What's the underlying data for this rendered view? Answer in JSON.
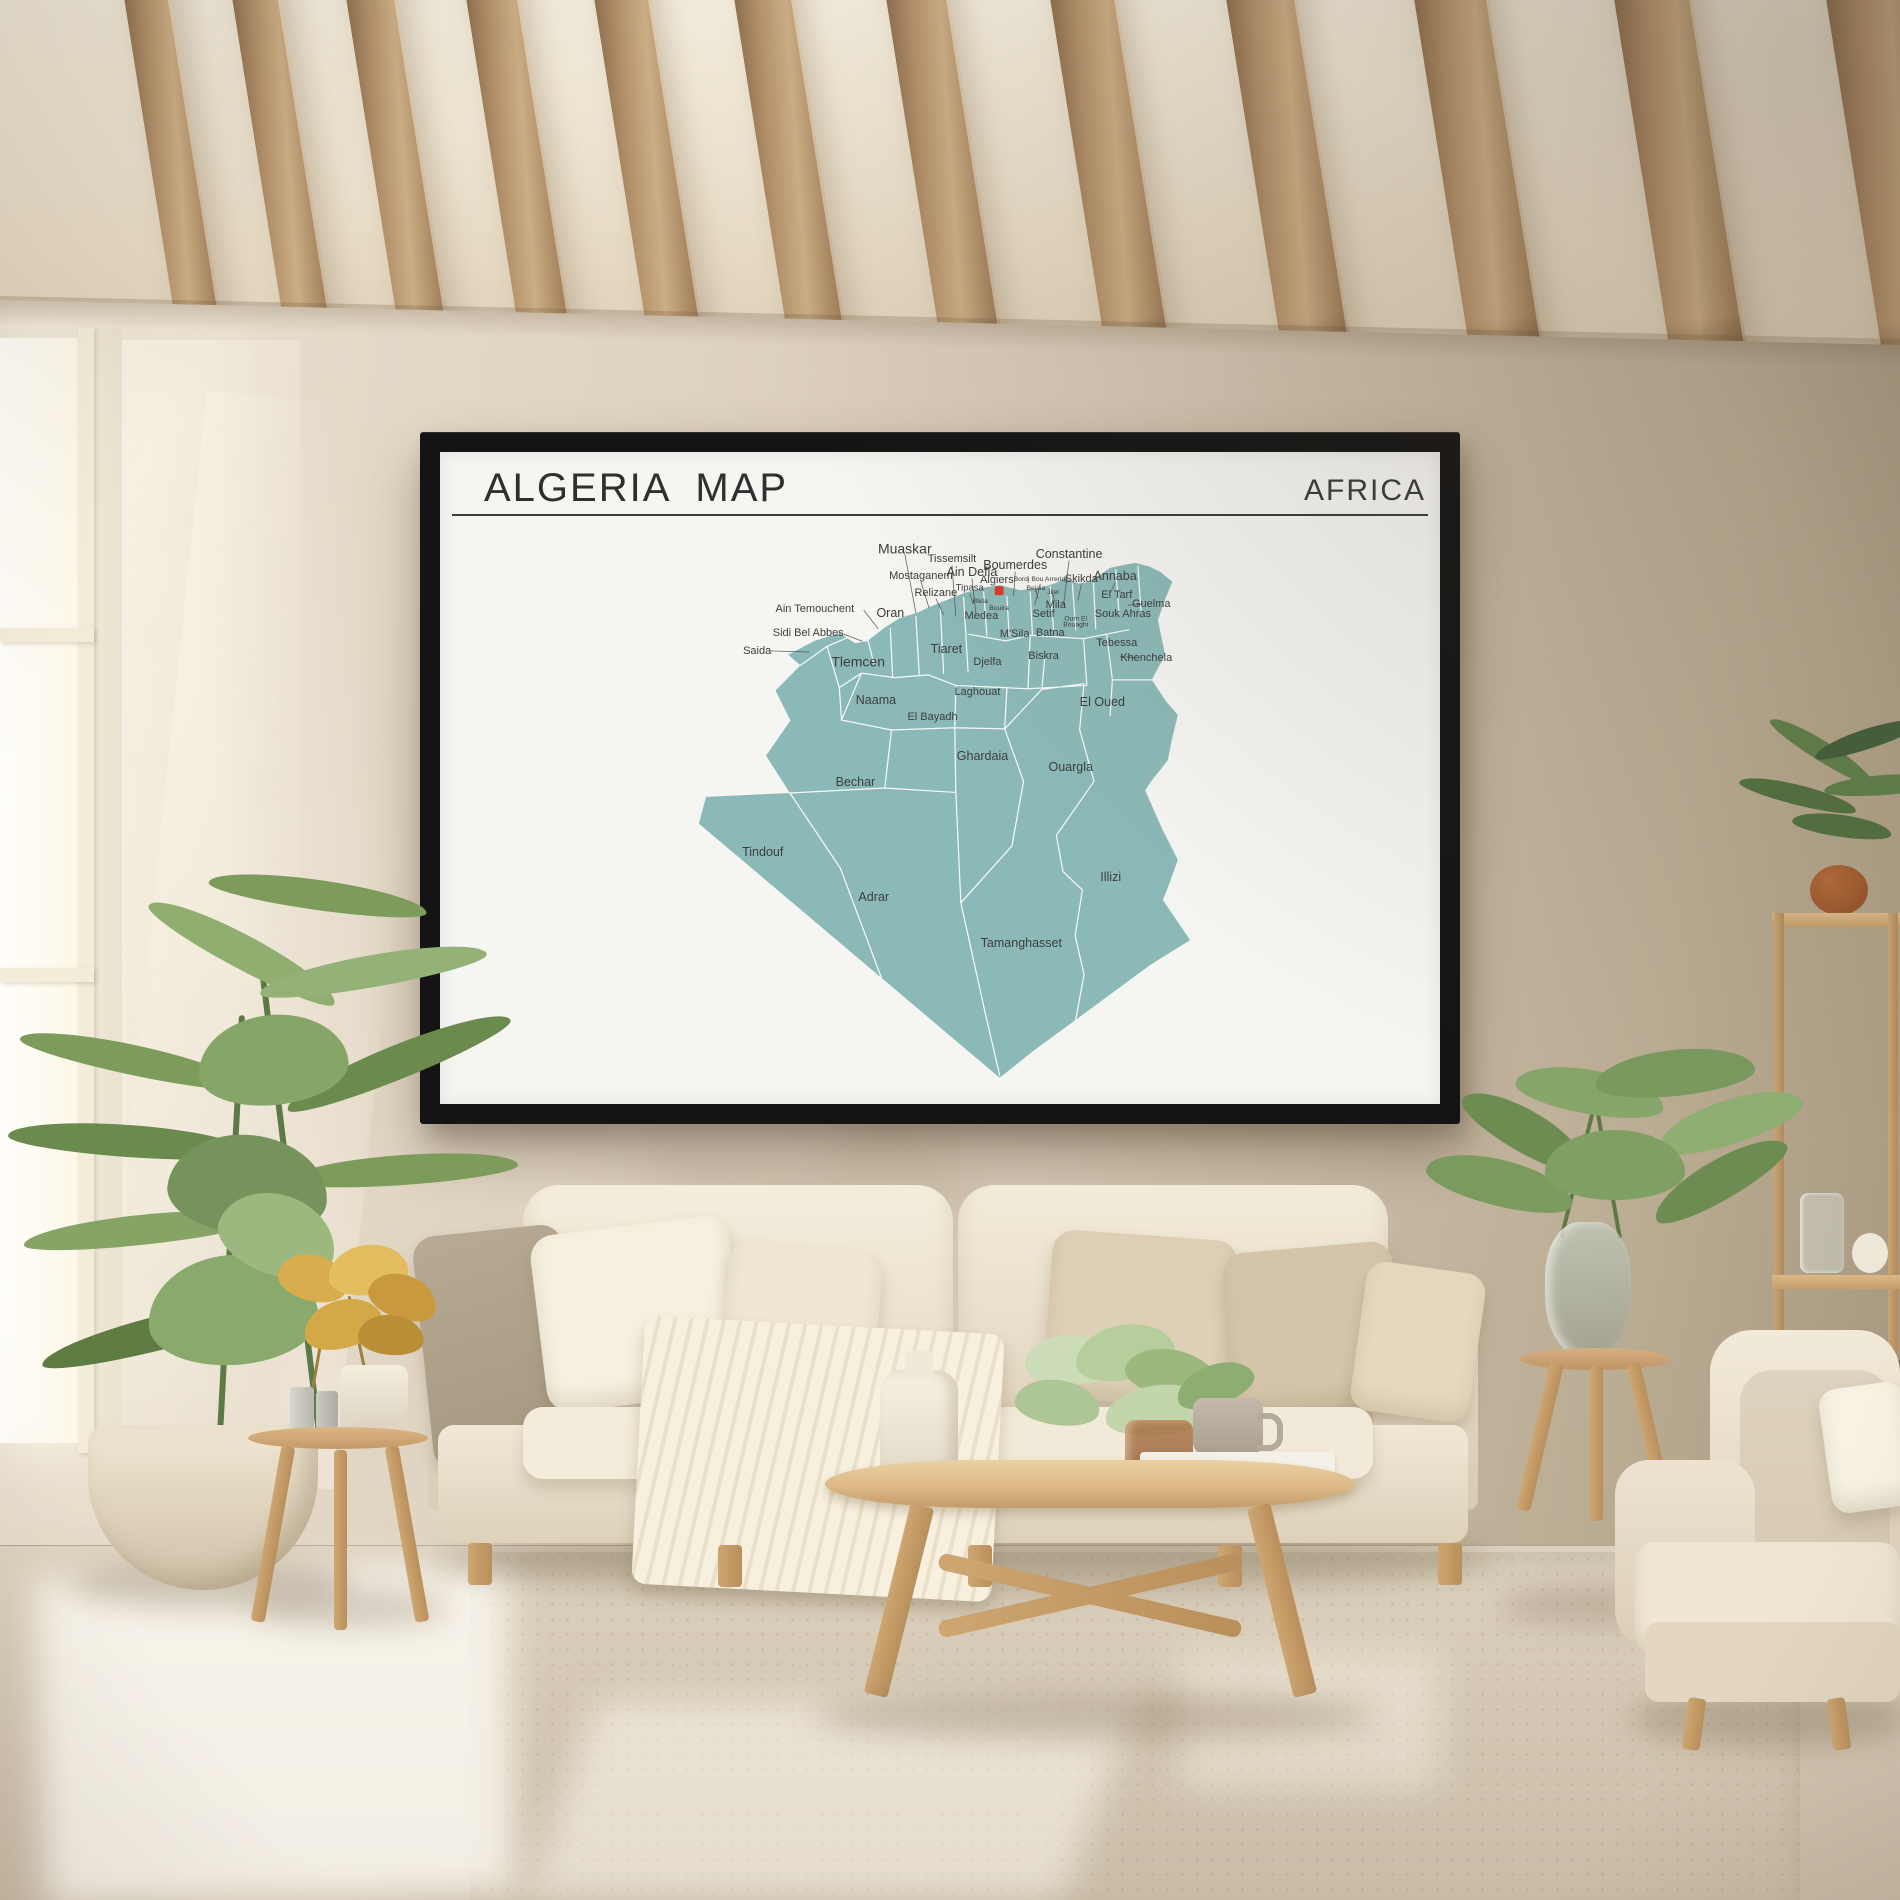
{
  "poster": {
    "title": "ALGERIA  MAP",
    "region_label": "AFRICA",
    "colors": {
      "frame": "#141414",
      "paper": "#f5f5f2",
      "rule": "#3a3a3a",
      "map_fill": "#8bb9b7",
      "map_border": "#ffffff",
      "label_text": "#3d3d3d",
      "leader": "#4a4a4a",
      "capital_marker": "#d93a30"
    },
    "map_labels": [
      {
        "text": "Muaskar",
        "x": 378,
        "y": 8,
        "size": "xl"
      },
      {
        "text": "Tissemsilt",
        "x": 463,
        "y": 26,
        "size": "md"
      },
      {
        "text": "Ain Defla",
        "x": 499,
        "y": 50,
        "size": "lg"
      },
      {
        "text": "Boumerdes",
        "x": 577,
        "y": 38,
        "size": "lg"
      },
      {
        "text": "Constantine",
        "x": 674,
        "y": 18,
        "size": "lg"
      },
      {
        "text": "Mostaganem",
        "x": 407,
        "y": 56,
        "size": "md"
      },
      {
        "text": "Relizane",
        "x": 434,
        "y": 86,
        "size": "md"
      },
      {
        "text": "Tipasa",
        "x": 495,
        "y": 77,
        "size": "sm"
      },
      {
        "text": "Algiers",
        "x": 544,
        "y": 62,
        "size": "md"
      },
      {
        "text": "Bordj Bou Arreridj",
        "x": 622,
        "y": 62,
        "size": "xs"
      },
      {
        "text": "Bejaia",
        "x": 614,
        "y": 79,
        "size": "xs"
      },
      {
        "text": "Jijel",
        "x": 645,
        "y": 86,
        "size": "xs"
      },
      {
        "text": "Skikda",
        "x": 696,
        "y": 61,
        "size": "md"
      },
      {
        "text": "Annaba",
        "x": 757,
        "y": 58,
        "size": "lg"
      },
      {
        "text": "El Tarf",
        "x": 760,
        "y": 90,
        "size": "md"
      },
      {
        "text": "Guelma",
        "x": 822,
        "y": 106,
        "size": "md"
      },
      {
        "text": "Souk Ahras",
        "x": 771,
        "y": 124,
        "size": "md"
      },
      {
        "text": "Mila",
        "x": 650,
        "y": 108,
        "size": "md"
      },
      {
        "text": "Setif",
        "x": 628,
        "y": 124,
        "size": "md"
      },
      {
        "text": "Oum El Bouaghi",
        "x": 686,
        "y": 140,
        "size": "xs",
        "w": 46
      },
      {
        "text": "Batna",
        "x": 640,
        "y": 158,
        "size": "md"
      },
      {
        "text": "Biskra",
        "x": 628,
        "y": 199,
        "size": "md"
      },
      {
        "text": "Tebessa",
        "x": 760,
        "y": 176,
        "size": "md"
      },
      {
        "text": "Khenchela",
        "x": 813,
        "y": 203,
        "size": "md"
      },
      {
        "text": "Ain Temouchent",
        "x": 216,
        "y": 115,
        "size": "md"
      },
      {
        "text": "Oran",
        "x": 352,
        "y": 124,
        "size": "lg"
      },
      {
        "text": "Sidi Bel Abbes",
        "x": 204,
        "y": 158,
        "size": "md"
      },
      {
        "text": "Saida",
        "x": 112,
        "y": 190,
        "size": "md"
      },
      {
        "text": "Tlemcen",
        "x": 294,
        "y": 210,
        "size": "xl"
      },
      {
        "text": "Tiaret",
        "x": 453,
        "y": 189,
        "size": "lg"
      },
      {
        "text": "Djelfa",
        "x": 527,
        "y": 210,
        "size": "md"
      },
      {
        "text": "M'Sila",
        "x": 576,
        "y": 160,
        "size": "md"
      },
      {
        "text": "Medea",
        "x": 516,
        "y": 128,
        "size": "md"
      },
      {
        "text": "Blida",
        "x": 514,
        "y": 102,
        "size": "xs"
      },
      {
        "text": "Bouira",
        "x": 548,
        "y": 115,
        "size": "xs"
      },
      {
        "text": "Naama",
        "x": 326,
        "y": 280,
        "size": "lg"
      },
      {
        "text": "El Bayadh",
        "x": 428,
        "y": 309,
        "size": "md"
      },
      {
        "text": "Laghouat",
        "x": 509,
        "y": 264,
        "size": "md"
      },
      {
        "text": "El Oued",
        "x": 734,
        "y": 284,
        "size": "lg"
      },
      {
        "text": "Ghardaia",
        "x": 518,
        "y": 381,
        "size": "lg"
      },
      {
        "text": "Ouargla",
        "x": 677,
        "y": 400,
        "size": "lg"
      },
      {
        "text": "Bechar",
        "x": 289,
        "y": 427,
        "size": "lg"
      },
      {
        "text": "Tindouf",
        "x": 122,
        "y": 553,
        "size": "lg"
      },
      {
        "text": "Adrar",
        "x": 322,
        "y": 634,
        "size": "lg"
      },
      {
        "text": "Illizi",
        "x": 749,
        "y": 598,
        "size": "lg"
      },
      {
        "text": "Tamanghasset",
        "x": 588,
        "y": 716,
        "size": "lg"
      }
    ]
  },
  "scene": {
    "colors": {
      "ceiling": "#f0e8d7",
      "beam_wood": "#b2906a",
      "wall_light": "#ece2d2",
      "wall_dark": "#a6977e",
      "window_glow": "#fffdf4",
      "sofa_cream": "#f0e8d7",
      "rug": "#e4dccb",
      "floor": "#d8cdbb",
      "wood": "#d3ab79",
      "foliage": "#7d9b5b",
      "terracotta": "#a35f35"
    }
  }
}
